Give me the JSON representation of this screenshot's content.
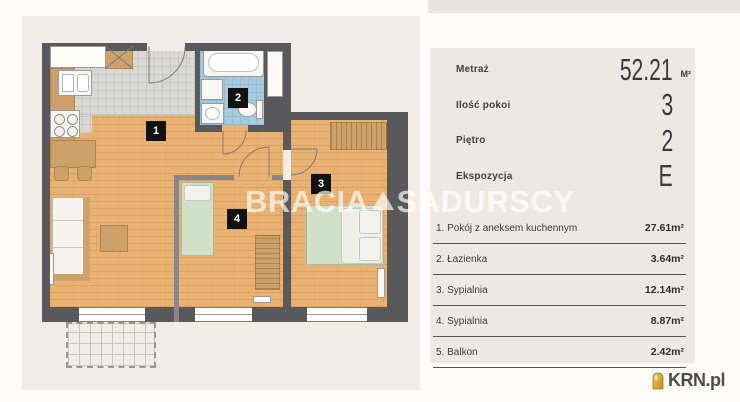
{
  "watermark": {
    "part1": "BRACIA",
    "part2": "SADURSCY",
    "separator_icon": "triangle"
  },
  "floorplan": {
    "room_tags": [
      "1",
      "2",
      "3",
      "4"
    ]
  },
  "panel": {
    "specs": [
      {
        "label": "Metraż",
        "value": "52.21",
        "unit": "M²"
      },
      {
        "label": "Ilość pokoi",
        "value": "3",
        "unit": ""
      },
      {
        "label": "Piętro",
        "value": "2",
        "unit": ""
      },
      {
        "label": "Ekspozycja",
        "value": "E",
        "unit": ""
      }
    ],
    "rooms": [
      {
        "label": "1. Pokój z aneksem kuchennym",
        "area": "27.61m²"
      },
      {
        "label": "2. Łazienka",
        "area": "3.64m²"
      },
      {
        "label": "3. Sypialnia",
        "area": "12.14m²"
      },
      {
        "label": "4. Sypialnia",
        "area": "8.87m²"
      },
      {
        "label": "5. Balkon",
        "area": "2.42m²"
      }
    ]
  },
  "logo": {
    "text": "KRN.pl"
  },
  "colors": {
    "wood_floor": "#e9b273",
    "tile_floor": "#d8d8d6",
    "bath_floor": "#a6cbdd",
    "wall": "#59595c",
    "furniture_tan": "#cda26a",
    "bed_green": "#cfe0c8",
    "panel_bg": "#ece9e2",
    "logo_gold": "#d9a62a"
  }
}
